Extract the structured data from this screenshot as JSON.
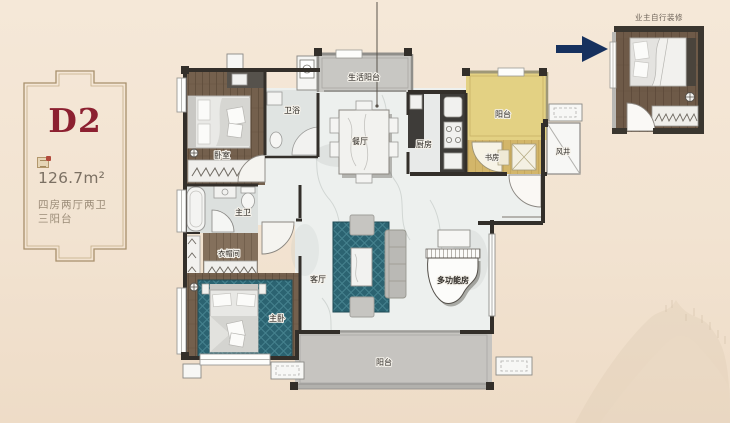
{
  "unit_card": {
    "unit_name": "D2",
    "area": "126.7m²",
    "spec_line1": "四房两厅两卫",
    "spec_line2": "三阳台"
  },
  "callout": {
    "title": "业主自行装修"
  },
  "rooms": {
    "bedroom": "卧室",
    "bath": "卫浴",
    "service_balcony": "生活阳台",
    "dining": "餐厅",
    "kitchen": "厨房",
    "balcony_top": "阳台",
    "study": "书房",
    "wind_shaft": "风井",
    "master_bath": "主卫",
    "cloakroom": "衣帽间",
    "master_bedroom": "主卧",
    "living": "客厅",
    "multi_room": "多功能房",
    "balcony_bottom": "阳台"
  },
  "colors": {
    "accent_red": "#8c2030",
    "arrow_blue": "#16315e",
    "highlight_yellow": "#e3d183",
    "rug_teal": "#2b6371"
  }
}
